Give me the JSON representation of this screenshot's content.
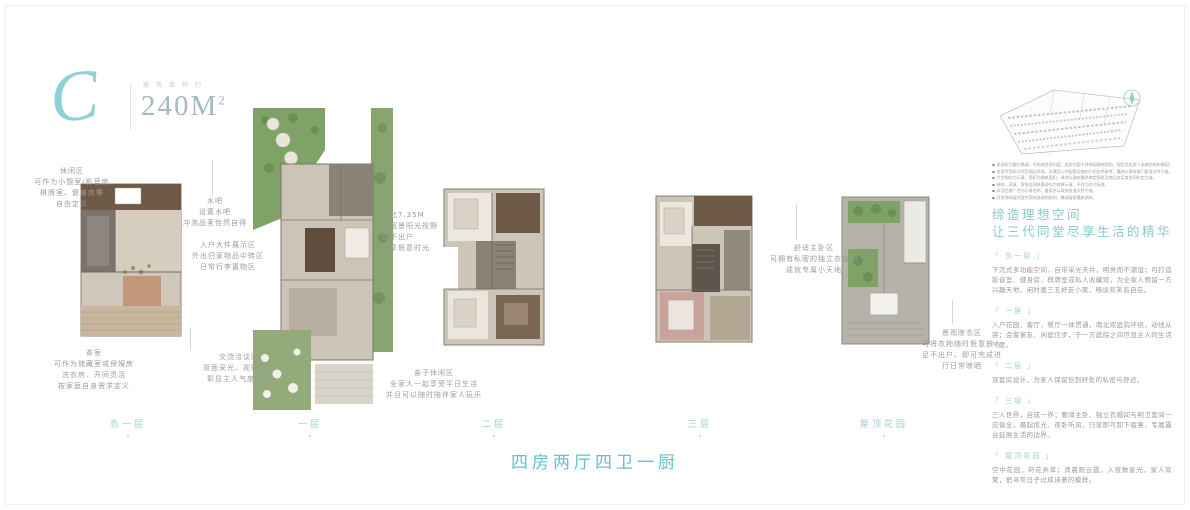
{
  "colors": {
    "accent": "#63c1c9",
    "label_teal": "#9fced3",
    "annotation_gray": "#9b9b9b"
  },
  "header": {
    "monogram": "C",
    "area_label": "建筑面积约",
    "area_value": "240M",
    "area_sup": "2"
  },
  "floors": [
    {
      "label": "负一层"
    },
    {
      "label": "一层"
    },
    {
      "label": "二层"
    },
    {
      "label": "三层"
    },
    {
      "label": "屋顶花园"
    }
  ],
  "annotations": {
    "leisure": {
      "lines": [
        "休闲区",
        "可作为小憩室/影音房",
        "棋牌室、健身房等",
        "自由定义"
      ]
    },
    "tearoom": {
      "lines": [
        "茶室",
        "可作为储藏室或保姆房",
        "洗衣房、开间灵活",
        "按家庭自身需求定义"
      ]
    },
    "waterbar": {
      "lines": [
        "水吧",
        "设置水吧",
        "冲泡品茗怡然自得"
      ]
    },
    "display": {
      "lines": [
        "入户大件展示区",
        "外出归家物品中转区",
        "日常行李置物区"
      ]
    },
    "talk": {
      "lines": [
        "交流洽谈区",
        "双面采光、视野开阔",
        "彰显主人气度风范"
      ]
    },
    "south": {
      "lines": [
        "南北7.35M",
        "拥宽景阳光视野",
        "足不出户",
        "尽享惬意时光"
      ]
    },
    "family": {
      "lines": [
        "亲子休闲区",
        "全家人一起享受平日生活",
        "并且可以随时陪伴家人玩乐"
      ]
    },
    "master": {
      "lines": [
        "舒适主卧区",
        "可拥有私密的独立衣帽间",
        "成就专属小天地"
      ]
    },
    "laundry": {
      "lines": [
        "景观晾衣区",
        "可将衣物随时惬意放入",
        "足不出户、即可完成进",
        "行日常晾晒"
      ]
    }
  },
  "sidebar": {
    "heading_line1": "缔造理想空间",
    "heading_line2": "让三代同堂尽享生活的精华",
    "sections": [
      {
        "label": "「 负一层 」",
        "text": "下沉式多功能空间，自带采光天井，明亮而不潮湿；可打造影音室、健身房、棋牌室或私人收藏馆，为全家人预留一方兴趣天地，闲时邀三五好友小聚，畅谈欢笑皆自在。"
      },
      {
        "label": "「 一层 」",
        "text": "入户花园、客厅、餐厅一体贯通，南北双庭院环绕，动线从容；会客宴友、闲庭信步，于一方庭院之间尽显主人的生活气度。"
      },
      {
        "label": "「 二层 」",
        "text": "双套房设计，为家人保留恰到好处的私密与舒适。"
      },
      {
        "label": "「 三层 」",
        "text": "三人世界，自成一界；奢阔主卧、独立衣帽间与明卫套间一应俱全，晨起揽光、夜卧听风，归家即可卸下疲惫，专属露台延展生活的边界。"
      },
      {
        "label": "「 屋顶花园 」",
        "text": "空中花园，莳花弄草；清晨观云霞，入夜数星光，家人欢聚，把寻常日子过成诗意的模样。"
      }
    ],
    "disclaimers": [
      "本资料为要约邀请，不构成合同内容；相关内容不排除因政府规划、规定及出卖人未能控制的原因发生变化。",
      "本宣传资料对项目周边环境、交通及公共配套设施的介绍仅供参考，最终以政府部门批准文件为准。",
      "户型图仅为示意，面积为建筑面积，具体以政府最终审定图纸及商品房买卖合同约定为准。",
      "装修、家具、家电及园林景观仅为效果示意，不作为交付标准。",
      "本项目推广名为示意名称，备案名以政府批准文件为准。",
      "开发商保留对宣传资料修改的权利，敬请留意最新资料。"
    ]
  },
  "footer": {
    "tagline": "四房两厅四卫一厨"
  },
  "icons": {
    "compass": "compass-icon"
  }
}
